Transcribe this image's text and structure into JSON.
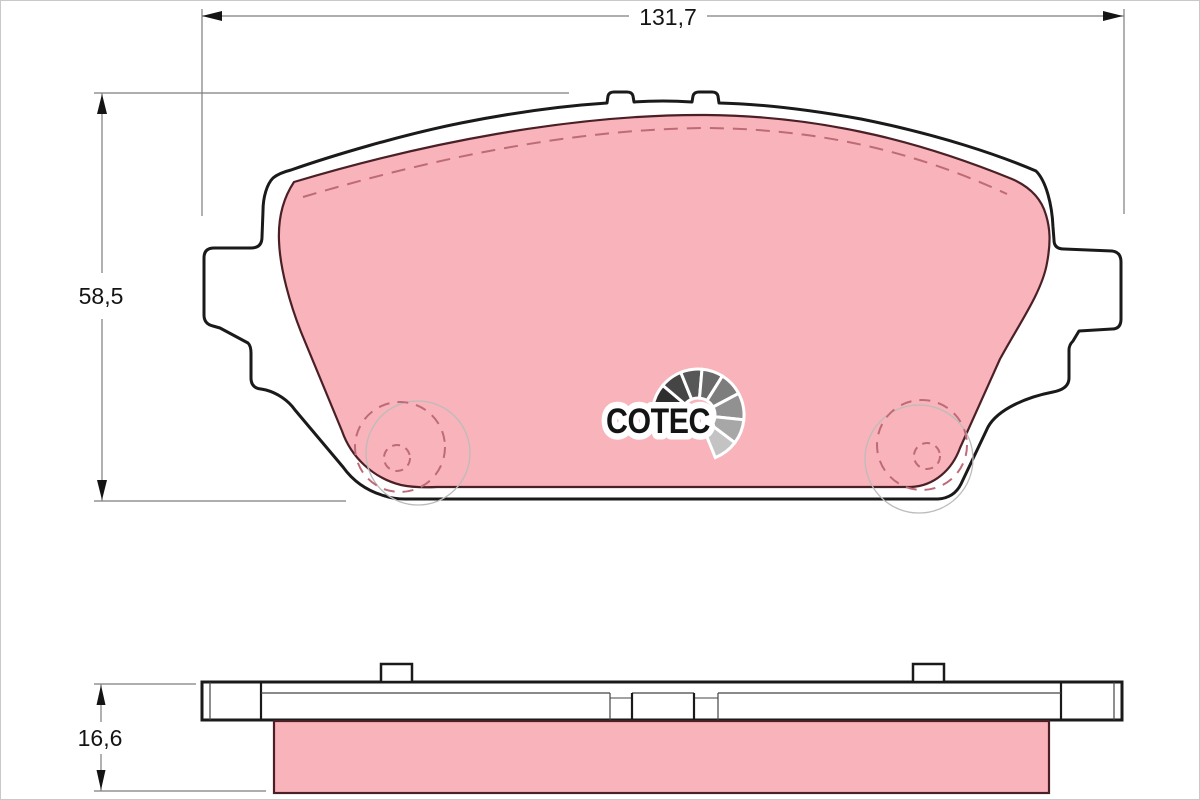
{
  "drawing": {
    "type": "brake-pad-technical-drawing",
    "description": "Disc brake pad dimensional drawing, top view with friction material and side profile view",
    "views": {
      "top_view": "pad front view with backing plate, friction material, rivet hole circles",
      "side_view": "pad edge profile with backing plate and friction material block"
    }
  },
  "dimensions": {
    "width_mm": {
      "label": "131,7"
    },
    "height_mm": {
      "label": "58,5"
    },
    "thickness_mm": {
      "label": "16,6"
    }
  },
  "logo": {
    "text": "COTEC",
    "fan_shades": [
      "#2e2e2e",
      "#454545",
      "#575757",
      "#696969",
      "#7d7d7d",
      "#919191",
      "#a7a7a7",
      "#c3c3c3"
    ]
  },
  "colors": {
    "friction": "#f9b3ba",
    "friction_edge": "#4a2026",
    "dashed_line": "#bd6b77",
    "outline": "#1a1a1a",
    "dimension_line": "#7d7d7d",
    "text": "#141414",
    "faint_circle": "#bcbcbc",
    "background": "#ffffff"
  }
}
